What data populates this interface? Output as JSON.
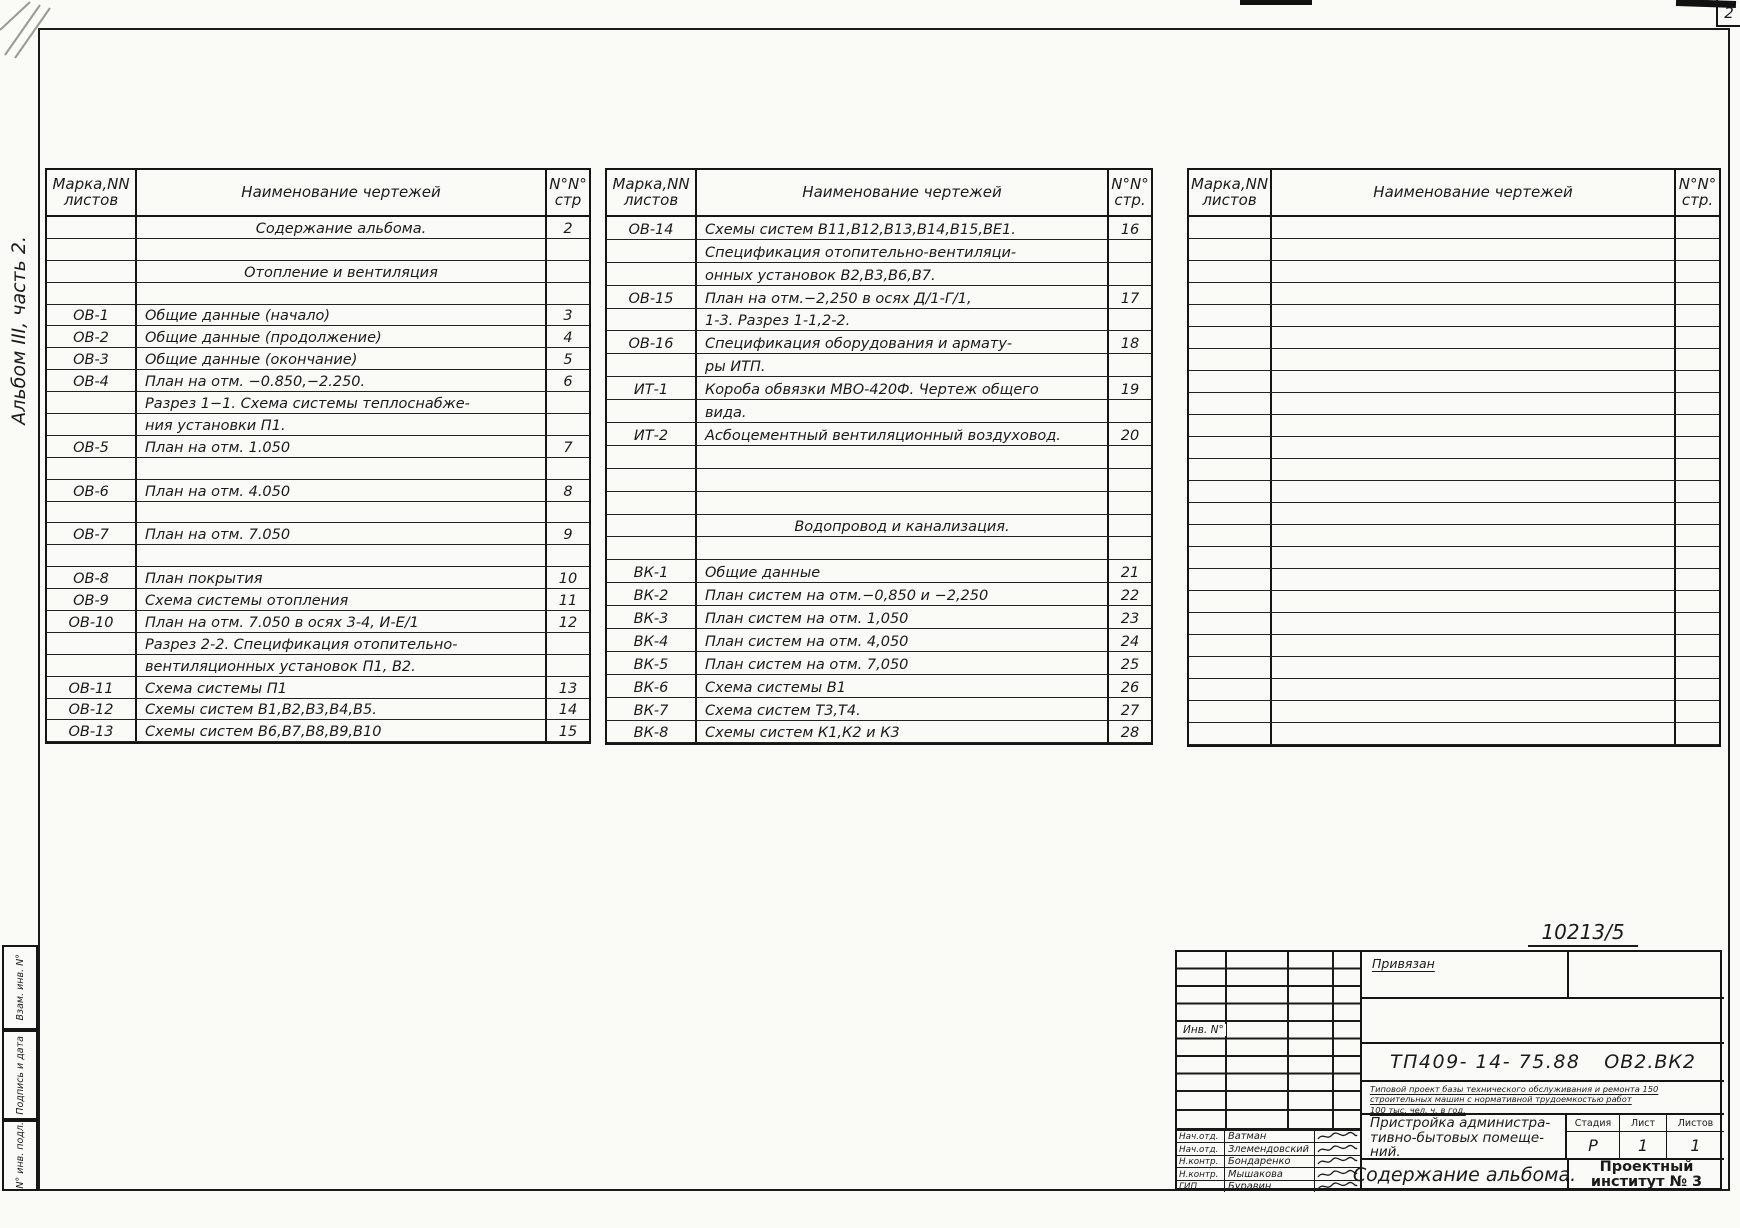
{
  "page": {
    "sheet_corner_number": "2",
    "album_label": "Альбом III, часть 2.",
    "handwritten_number": "10213/5",
    "left_stamps": [
      "Взам. инв. N°",
      "Подпись и дата",
      "N° инв. подл."
    ]
  },
  "tables": [
    {
      "headers": {
        "mark": "Марка,NN листов",
        "name": "Наименование чертежей",
        "page": "N°N° стр"
      },
      "rows": [
        {
          "m": "",
          "n": "Содержание альбома.",
          "p": "2",
          "c": true
        },
        {},
        {
          "n": "Отопление и вентиляция",
          "c": true
        },
        {},
        {
          "m": "ОВ-1",
          "n": "Общие данные (начало)",
          "p": "3"
        },
        {
          "m": "ОВ-2",
          "n": "Общие данные (продолжение)",
          "p": "4"
        },
        {
          "m": "ОВ-3",
          "n": "Общие данные (окончание)",
          "p": "5"
        },
        {
          "m": "ОВ-4",
          "n": "План на отм. −0.850,−2.250.",
          "p": "6"
        },
        {
          "n": "Разрез 1−1. Схема системы теплоснабже-"
        },
        {
          "n": "ния установки П1."
        },
        {
          "m": "ОВ-5",
          "n": "План на отм. 1.050",
          "p": "7"
        },
        {},
        {
          "m": "ОВ-6",
          "n": "План на отм. 4.050",
          "p": "8"
        },
        {},
        {
          "m": "ОВ-7",
          "n": "План на отм. 7.050",
          "p": "9"
        },
        {},
        {
          "m": "ОВ-8",
          "n": "План покрытия",
          "p": "10"
        },
        {
          "m": "ОВ-9",
          "n": "Схема системы отопления",
          "p": "11"
        },
        {
          "m": "ОВ-10",
          "n": "План на отм. 7.050 в осях 3-4, И-Е/1",
          "p": "12"
        },
        {
          "n": "Разрез 2-2.  Спецификация отопительно-"
        },
        {
          "n": "вентиляционных установок П1, В2."
        },
        {
          "m": "ОВ-11",
          "n": "Схема системы П1",
          "p": "13"
        },
        {
          "m": "ОВ-12",
          "n": "Схемы систем В1,В2,В3,В4,В5.",
          "p": "14"
        },
        {
          "m": "ОВ-13",
          "n": "Схемы систем В6,В7,В8,В9,В10",
          "p": "15"
        }
      ]
    },
    {
      "headers": {
        "mark": "Марка,NN листов",
        "name": "Наименование чертежей",
        "page": "N°N° стр."
      },
      "rows": [
        {
          "m": "ОВ-14",
          "n": "Схемы систем В11,В12,В13,В14,В15,ВЕ1.",
          "p": "16"
        },
        {
          "n": "Спецификация отопительно-вентиляци-"
        },
        {
          "n": "онных установок В2,В3,В6,В7."
        },
        {
          "m": "ОВ-15",
          "n": "   План на отм.−2,250 в осях Д/1-Г/1,",
          "p": "17"
        },
        {
          "n": "1-3.  Разрез 1-1,2-2."
        },
        {
          "m": "ОВ-16",
          "n": "Спецификация оборудования и армату-",
          "p": "18"
        },
        {
          "n": "ры ИТП."
        },
        {
          "m": "ИТ-1",
          "n": "Короба обвязки МВО-420Ф. Чертеж общего",
          "p": "19"
        },
        {
          "n": "вида."
        },
        {
          "m": "ИТ-2",
          "n": "Асбоцементный вентиляционный воздуховод.",
          "p": "20"
        },
        {},
        {},
        {},
        {
          "n": "Водопровод и канализация.",
          "c": true
        },
        {},
        {
          "m": "ВК-1",
          "n": "Общие данные",
          "p": "21"
        },
        {
          "m": "ВК-2",
          "n": "План систем на отм.−0,850 и −2,250",
          "p": "22"
        },
        {
          "m": "ВК-3",
          "n": "План систем на отм. 1,050",
          "p": "23"
        },
        {
          "m": "ВК-4",
          "n": "План систем на отм. 4,050",
          "p": "24"
        },
        {
          "m": "ВК-5",
          "n": "План систем на отм. 7,050",
          "p": "25"
        },
        {
          "m": "ВК-6",
          "n": "Схема системы В1",
          "p": "26"
        },
        {
          "m": "ВК-7",
          "n": "Схема систем Т3,Т4.",
          "p": "27"
        },
        {
          "m": "ВК-8",
          "n": "Схемы систем К1,К2 и К3",
          "p": "28"
        }
      ]
    },
    {
      "headers": {
        "mark": "Марка,NN листов",
        "name": "Наименование чертежей",
        "page": "N°N° стр."
      },
      "rows": [
        {},
        {},
        {},
        {},
        {},
        {},
        {},
        {},
        {},
        {},
        {},
        {},
        {},
        {},
        {},
        {},
        {},
        {},
        {},
        {},
        {},
        {},
        {},
        {}
      ]
    }
  ],
  "title_block": {
    "binding_note": "Привязан",
    "project_code": "ТП409- 14- 75.88",
    "doc_code": "ОВ2.ВК2",
    "project_desc": "Типовой проект базы технического обслуживания и ремонта 150\nстроительных машин с нормативной трудоемкостью работ\n100 тыс. чел. ч. в год.",
    "object_title": "Пристройка администра-\nтивно-бытовых помеще-\nний.",
    "stage_label": "Стадия",
    "sheet_label": "Лист",
    "sheets_label": "Листов",
    "stage_value": "Р",
    "sheet_value": "1",
    "sheets_value": "1",
    "doc_title": "Содержание альбома.",
    "organization": "Проектный\nинститут № 3",
    "inv_label": "Инв. N°",
    "signatures": [
      {
        "role": "Нач.отд.",
        "name": "Ватман"
      },
      {
        "role": "Нач.отд.",
        "name": "Злемендовский"
      },
      {
        "role": "Н.контр.",
        "name": "Бондаренко"
      },
      {
        "role": "Н.контр.",
        "name": "Мышакова"
      },
      {
        "role": "ГИП",
        "name": "Буравин"
      }
    ]
  }
}
